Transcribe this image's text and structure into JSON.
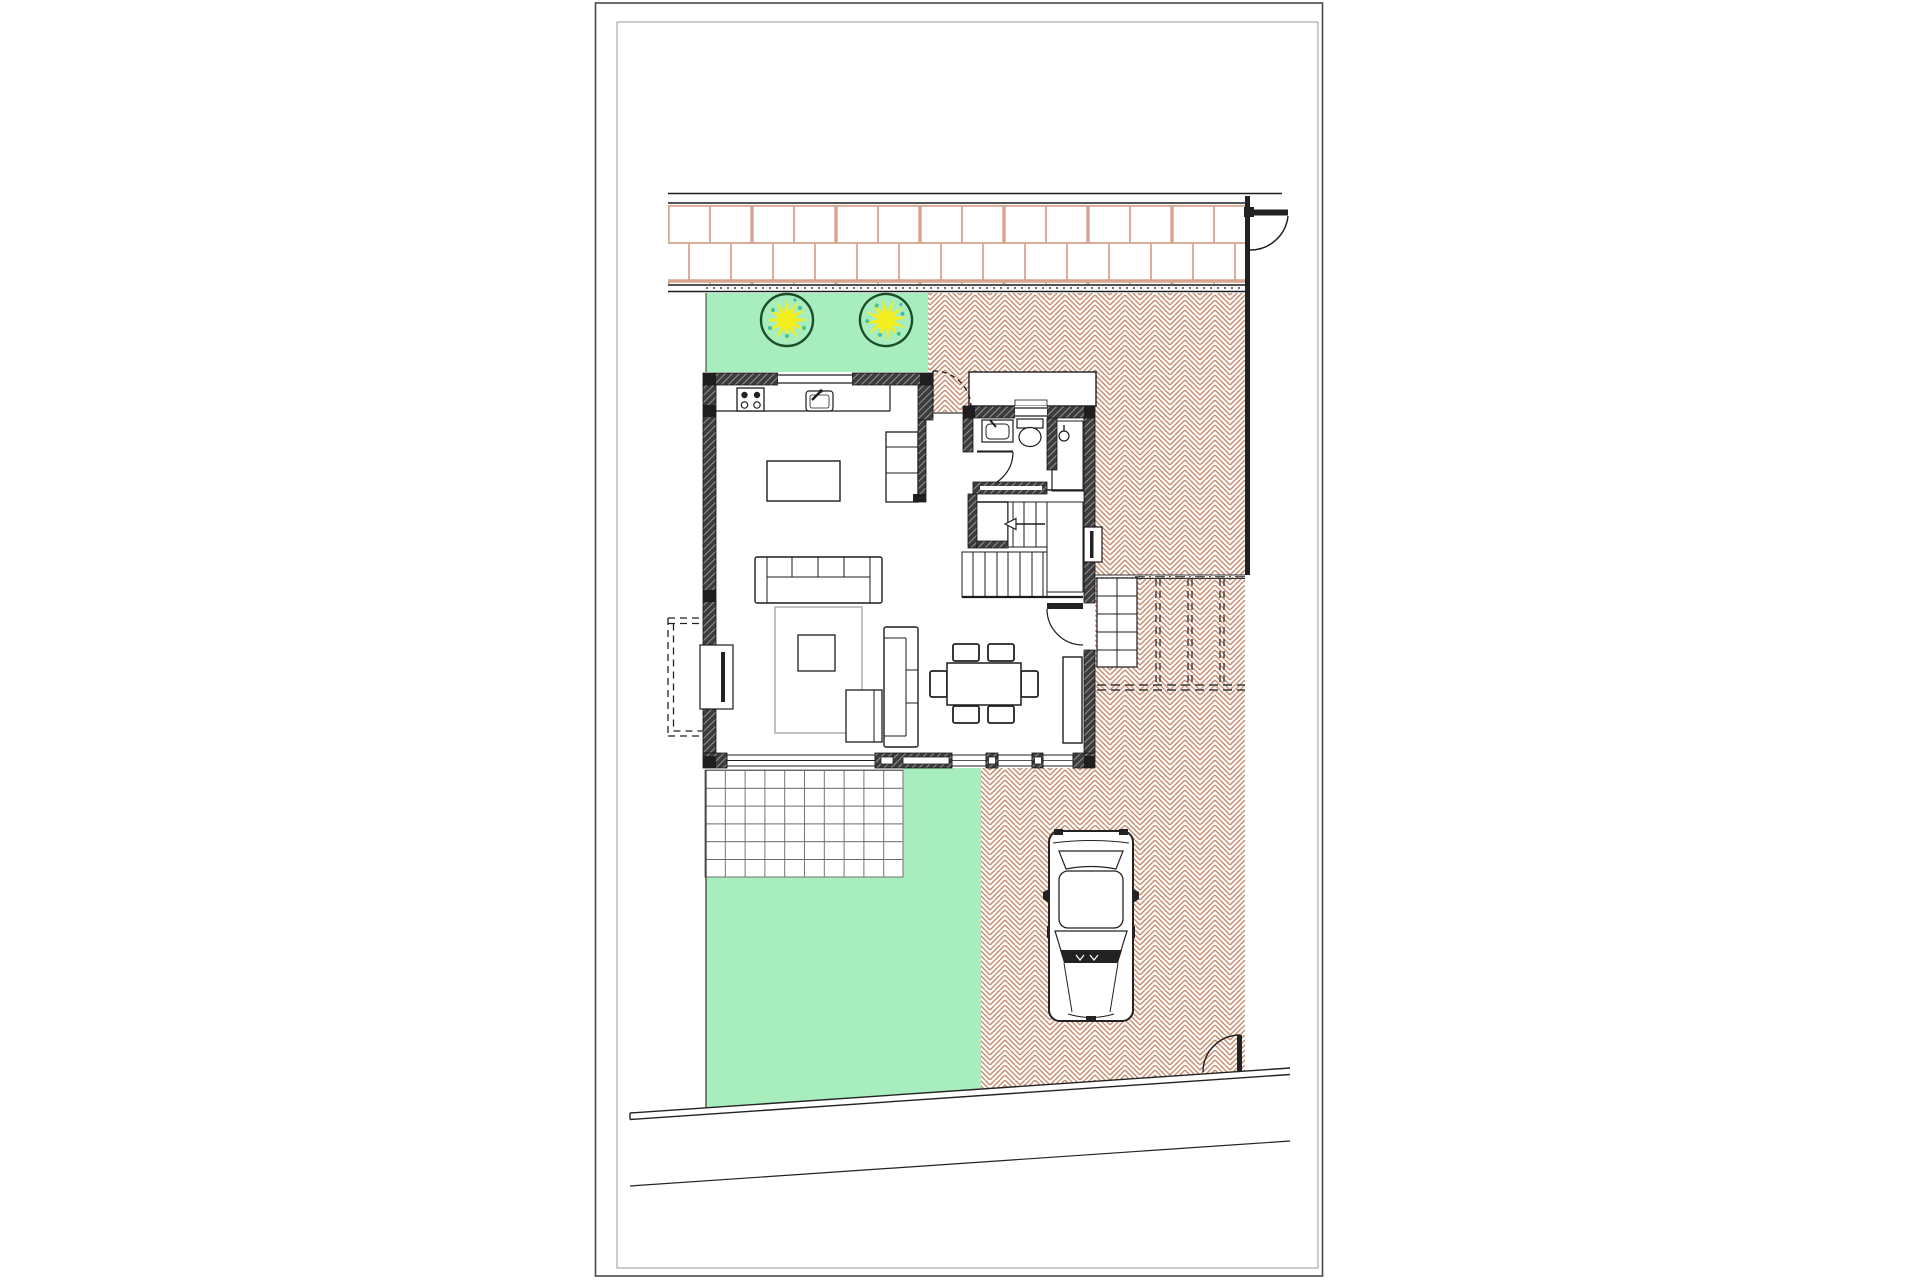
{
  "document": {
    "type": "architectural-site-plan",
    "description": "Ground floor site plan: house with open kitchen-living-dining room, bathroom, shower room and staircase; front garden strip with two trees, brick sidewalk band, herringbone paved courtyard and driveway with parked car, tiled terrace, rear lawn, boundary fences with gates",
    "visible_text": []
  },
  "colors": {
    "page_background": "#ffffff",
    "frame_outer": "#4a4a4a",
    "frame_inner": "#9a9a9a",
    "line": "#1c1c1c",
    "wall_fill": "#3c3c3c",
    "wall_hatch": "#8f8f8f",
    "grass": "#a8edbe",
    "tree_outline": "#1e4d2b",
    "tree_star": "#f4ee1f",
    "tree_speckle": "#43bfa3",
    "herringbone": "#c98869",
    "brick_band": "#d8a48e",
    "grid_line": "#666666",
    "rug_line": "#9a9a9a"
  },
  "features": {
    "trees": 2,
    "parked_cars": 1,
    "dining_chairs": 6,
    "stove_burners": 4,
    "areas": [
      "sidewalk-brick-band",
      "front-garden-strip",
      "paved-courtyard",
      "entrance-porch",
      "driveway",
      "exterior-steps",
      "parking-markings",
      "terrace-grid",
      "rear-lawn"
    ],
    "rooms": [
      "kitchen-living-dining-room",
      "bathroom",
      "shower-room",
      "staircase-hall"
    ]
  }
}
